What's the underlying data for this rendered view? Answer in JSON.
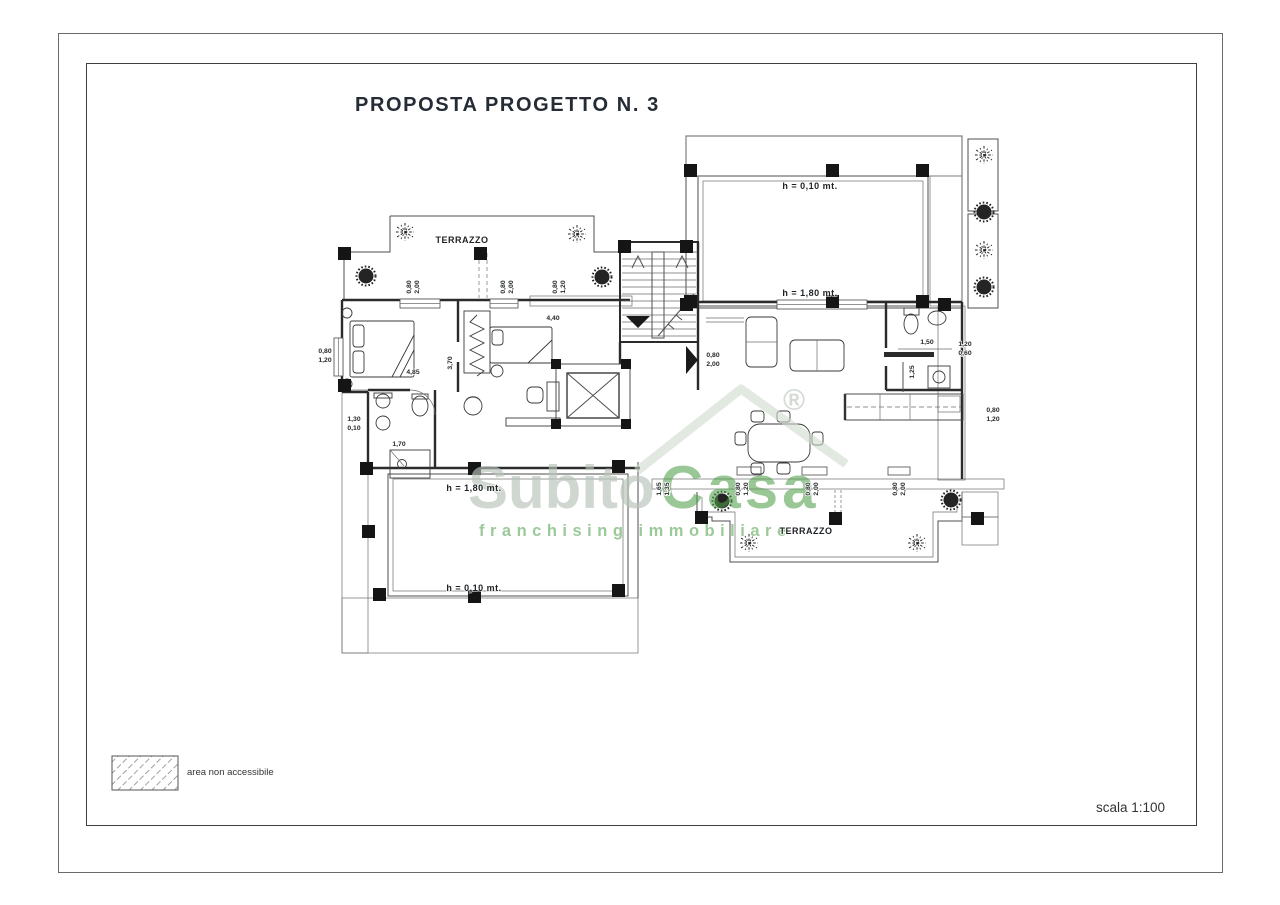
{
  "page": {
    "title": "PROPOSTA PROGETTO N. 3",
    "scale_label": "scala 1:100"
  },
  "legend": {
    "label": "area non accessibile"
  },
  "watermark": {
    "brand_part1": "Subito",
    "brand_part2": "Casa",
    "registered_mark": "®",
    "tagline": "franchising immobiliare",
    "green": "#4f9f49",
    "silver": "#b9c4ba",
    "roof_gray": "#cfd9ce"
  },
  "plan": {
    "ink_color": "#2b2b2b",
    "area_labels": [
      {
        "t": "TERRAZZO",
        "x": 462,
        "y": 243,
        "ls": 1.8
      },
      {
        "t": "h = 0,10 mt.",
        "x": 810,
        "y": 189
      },
      {
        "t": "h = 1,80 mt.",
        "x": 810,
        "y": 296
      },
      {
        "t": "h = 1,80 mt.",
        "x": 474,
        "y": 491
      },
      {
        "t": "h = 0,10 mt.",
        "x": 474,
        "y": 591
      },
      {
        "t": "TERRAZZO",
        "x": 806,
        "y": 534,
        "ls": 1.8
      }
    ],
    "dimensions": [
      {
        "t": "0,80",
        "x": 411,
        "y": 287,
        "r": 1
      },
      {
        "t": "2,00",
        "x": 419,
        "y": 287,
        "r": 1
      },
      {
        "t": "0,80",
        "x": 505,
        "y": 287,
        "r": 1
      },
      {
        "t": "2,00",
        "x": 513,
        "y": 287,
        "r": 1
      },
      {
        "t": "0,80",
        "x": 557,
        "y": 287,
        "r": 1
      },
      {
        "t": "1,20",
        "x": 565,
        "y": 287,
        "r": 1
      },
      {
        "t": "4,40",
        "x": 553,
        "y": 320
      },
      {
        "t": "0,80",
        "x": 325,
        "y": 353
      },
      {
        "t": "1,20",
        "x": 325,
        "y": 362
      },
      {
        "t": "4,85",
        "x": 413,
        "y": 374
      },
      {
        "t": "3,70",
        "x": 452,
        "y": 363,
        "r": 1
      },
      {
        "t": "1,30",
        "x": 354,
        "y": 421
      },
      {
        "t": "0,10",
        "x": 354,
        "y": 430
      },
      {
        "t": "1,70",
        "x": 399,
        "y": 446
      },
      {
        "t": "0,80",
        "x": 713,
        "y": 357
      },
      {
        "t": "2,00",
        "x": 713,
        "y": 366
      },
      {
        "t": "1,50",
        "x": 927,
        "y": 344
      },
      {
        "t": "1,25",
        "x": 914,
        "y": 372,
        "r": 1
      },
      {
        "t": "1,20",
        "x": 965,
        "y": 346
      },
      {
        "t": "0,60",
        "x": 965,
        "y": 355
      },
      {
        "t": "0,80",
        "x": 993,
        "y": 412
      },
      {
        "t": "1,20",
        "x": 993,
        "y": 421
      },
      {
        "t": "1,65",
        "x": 661,
        "y": 489,
        "r": 1
      },
      {
        "t": "1,35",
        "x": 669,
        "y": 489,
        "r": 1
      },
      {
        "t": "0,80",
        "x": 740,
        "y": 489,
        "r": 1
      },
      {
        "t": "1,20",
        "x": 748,
        "y": 489,
        "r": 1
      },
      {
        "t": "0,80",
        "x": 810,
        "y": 489,
        "r": 1
      },
      {
        "t": "2,00",
        "x": 818,
        "y": 489,
        "r": 1
      },
      {
        "t": "0,80",
        "x": 897,
        "y": 489,
        "r": 1
      },
      {
        "t": "2,00",
        "x": 905,
        "y": 489,
        "r": 1
      }
    ]
  }
}
